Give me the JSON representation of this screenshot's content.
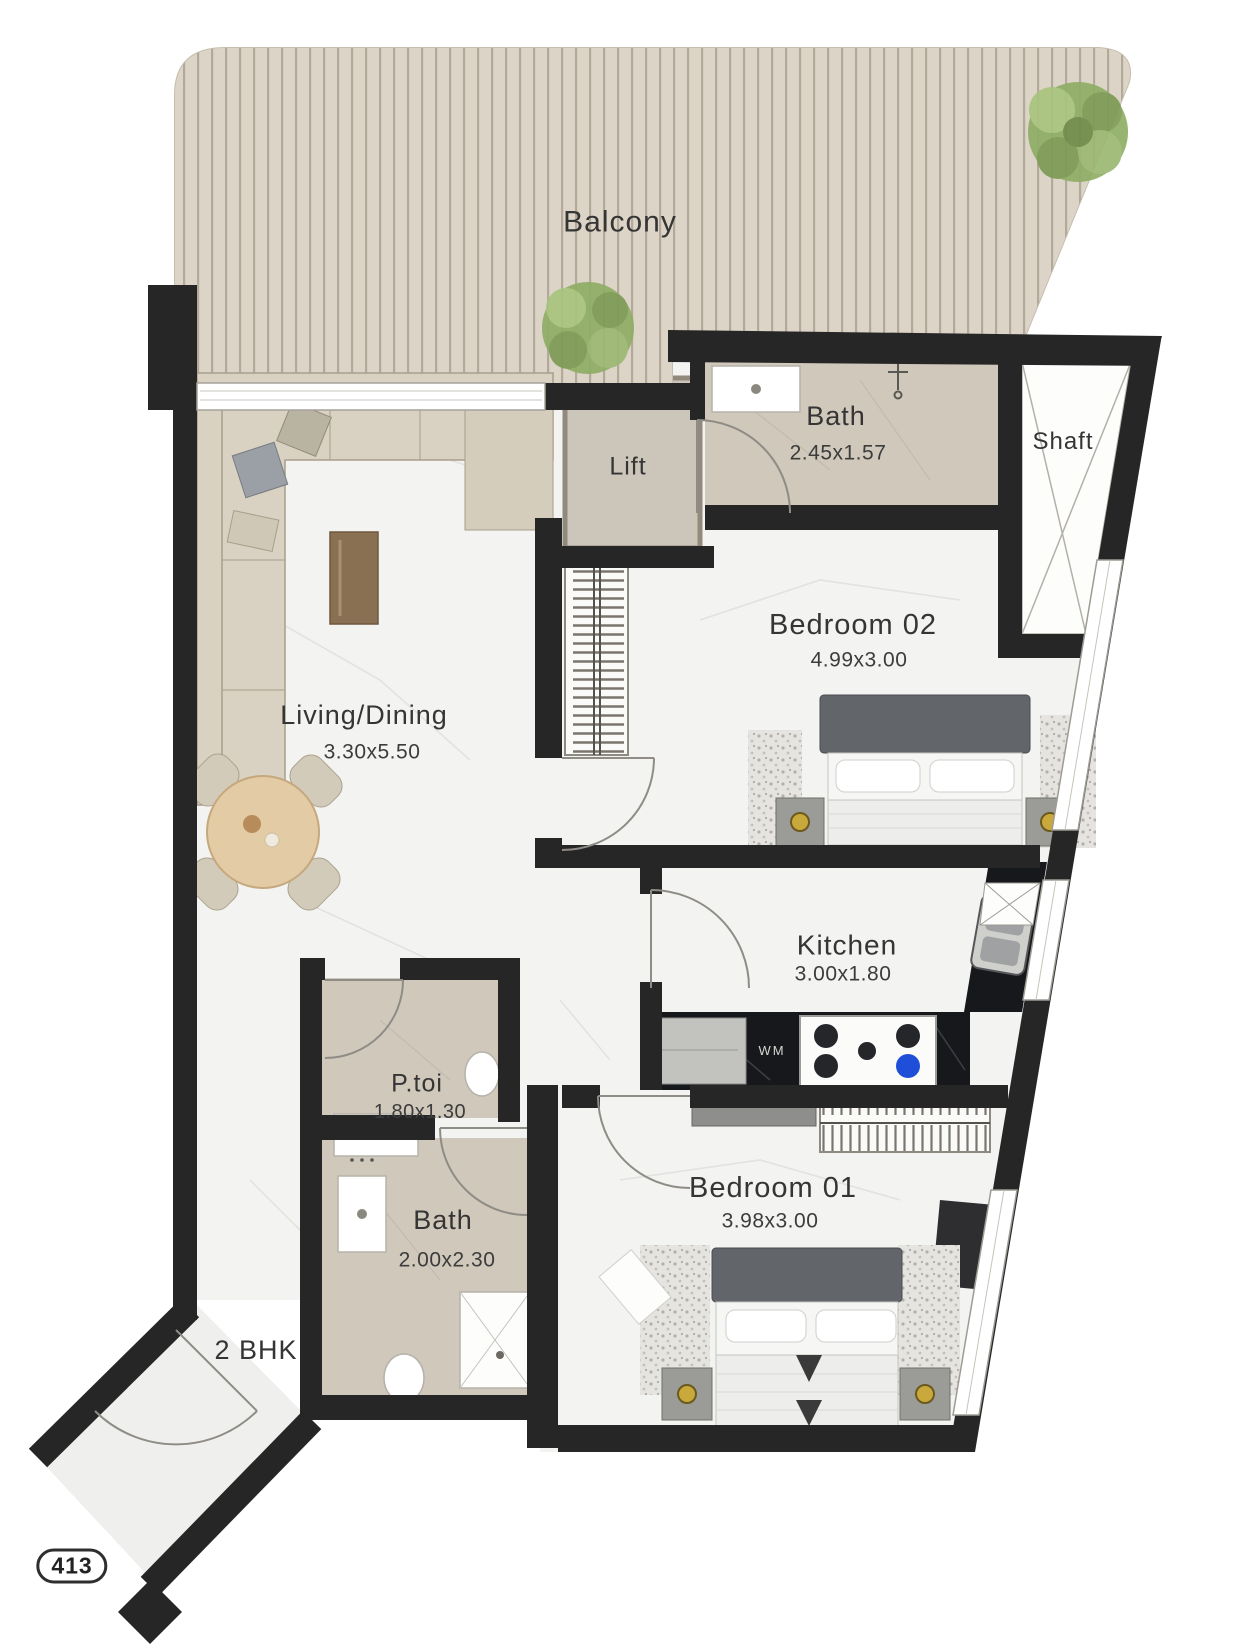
{
  "plan": {
    "unit_label": "2 BHK",
    "unit_number": "413",
    "rooms": {
      "balcony": {
        "name": "Balcony"
      },
      "living_dining": {
        "name": "Living/Dining",
        "dims": "3.30x5.50"
      },
      "lift": {
        "name": "Lift"
      },
      "bath_top": {
        "name": "Bath",
        "dims": "2.45x1.57"
      },
      "shaft": {
        "name": "Shaft"
      },
      "bedroom_02": {
        "name": "Bedroom 02",
        "dims": "4.99x3.00"
      },
      "kitchen": {
        "name": "Kitchen",
        "dims": "3.00x1.80"
      },
      "powder_toilet": {
        "name": "P.toi",
        "dims": "1.80x1.30"
      },
      "bath_lower": {
        "name": "Bath",
        "dims": "2.00x2.30"
      },
      "bedroom_01": {
        "name": "Bedroom 01",
        "dims": "3.98x3.00"
      }
    },
    "appliances": {
      "washing_machine": "WM"
    },
    "colors": {
      "wall": "#262626",
      "balcony_deck": "#dcd4c6",
      "bath_floor": "#cfc8bb",
      "marble_floor": "#f3f3f1",
      "counter_dark": "#17181b",
      "accent_gold": "#c9a83c",
      "tree_green": "#8fae66",
      "wood_table": "#e3cba6"
    }
  }
}
